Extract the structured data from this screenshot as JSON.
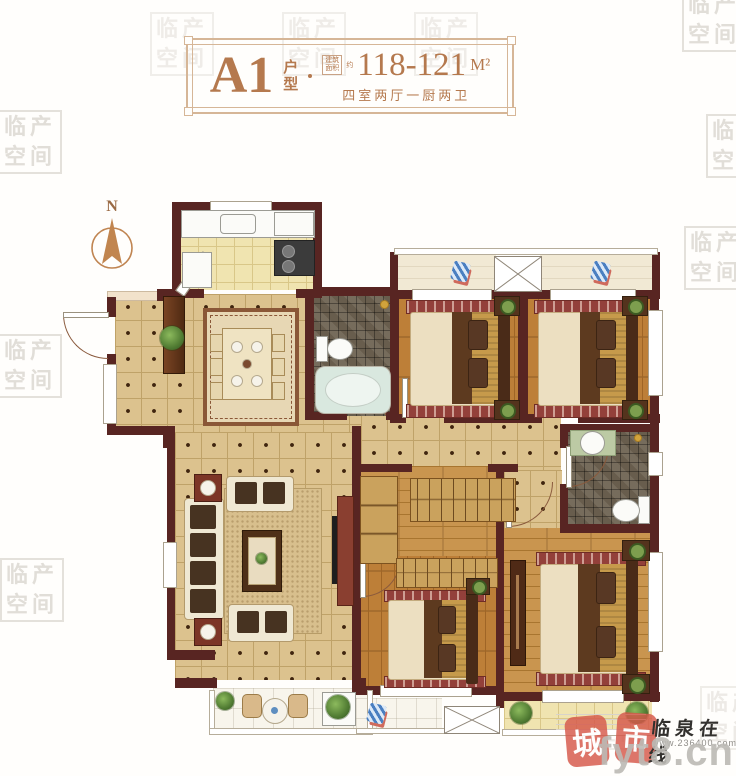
{
  "header": {
    "plan_code": "A1",
    "plan_type_char1": "户",
    "plan_type_char2": "型",
    "area_label_line1": "建筑",
    "area_label_line2": "面积",
    "area_approx": "约",
    "area_value": "118-121",
    "area_unit": "M²",
    "rooms_summary": "四室两厅一厨两卫"
  },
  "compass": {
    "north": "N"
  },
  "watermark": {
    "row1": "临产",
    "row2": "空间"
  },
  "branding": {
    "seal_left": "城",
    "seal_right": "市",
    "site_name": "临泉在线",
    "site_url": "www.236400.com",
    "big_watermark": "fyt8.cn"
  }
}
